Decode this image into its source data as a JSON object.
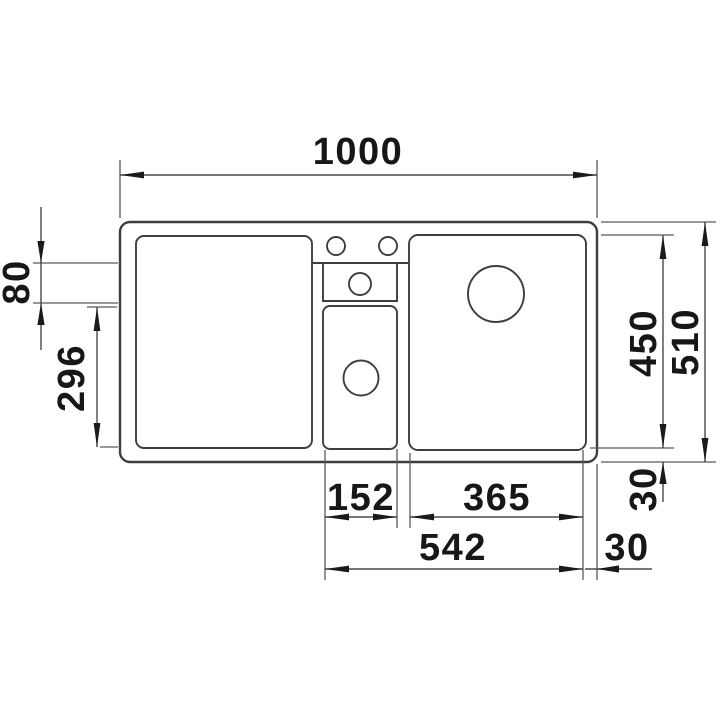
{
  "figure": {
    "type": "technical-drawing",
    "subject": "kitchen sink plan view with dimensions in mm",
    "background_color": "#ffffff",
    "line_color": "#3e3e3e",
    "text_color": "#171717"
  },
  "labels": {
    "overall_width": "1000",
    "tap_ledge_depth": "80",
    "half_bowl_depth": "296",
    "bowl_depth": "450",
    "overall_depth": "510",
    "half_bowl_width": "152",
    "main_bowl_width": "365",
    "bowls_total_width": "542",
    "right_edge_offset": "30",
    "bottom_edge_offset": "30"
  }
}
